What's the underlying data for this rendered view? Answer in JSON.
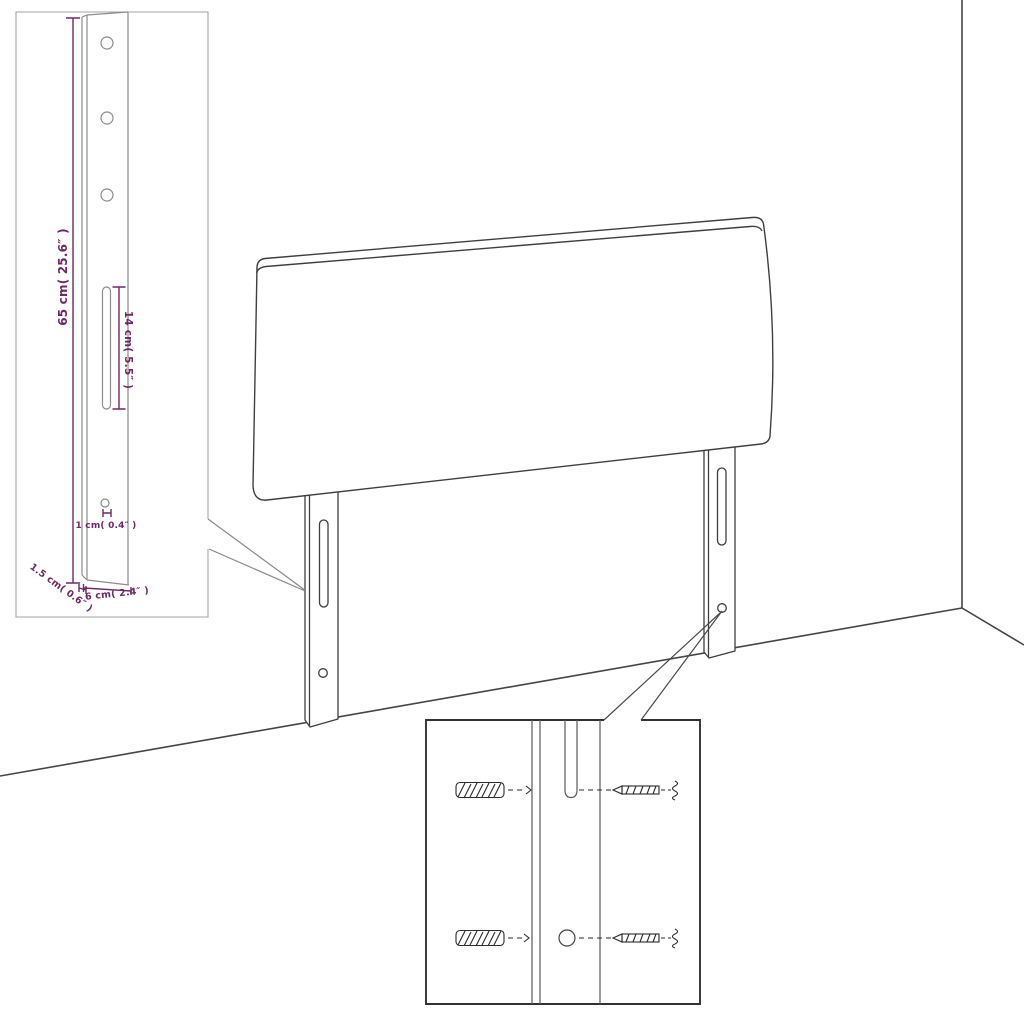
{
  "diagram": {
    "accent_color": "#6d2963",
    "line_color": "#3f3f3f",
    "insets": {
      "leg_detail": {
        "dimensions": {
          "leg_height": "65 cm( 25.6″ )",
          "slot_length": "14 cm( 5.5″ )",
          "hole_diameter": "1 cm( 0.4″ )",
          "leg_depth": "1.5 cm( 0.6″ )",
          "leg_width": "6 cm( 2.4″ )"
        }
      },
      "hardware_detail": {
        "icons": [
          "wall-plug-icon",
          "screw-icon",
          "wall-plug-icon",
          "screw-icon"
        ]
      }
    }
  }
}
